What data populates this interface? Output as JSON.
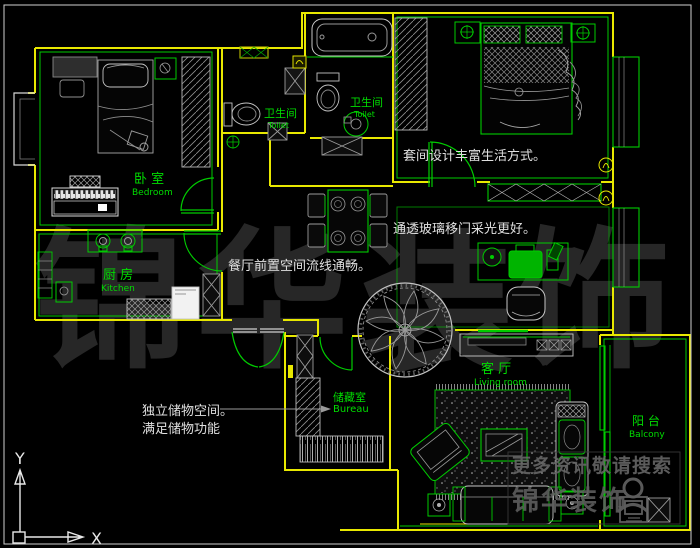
{
  "colors": {
    "background": "#000000",
    "wall": "#e8e800",
    "fixture_green": "#00cc00",
    "detail_gray": "#b5b5b5",
    "label_green": "#00dd00",
    "annotation_white": "#e0e0e0",
    "watermark_dark": "#272727",
    "watermark_gray": "#686868"
  },
  "rooms": {
    "bedroom": {
      "zh": "卧 室",
      "en": "Bedroom"
    },
    "toilet_a": {
      "zh": "卫生间",
      "en": "Toilet"
    },
    "toilet_b": {
      "zh": "卫生间",
      "en": "Toilet"
    },
    "kitchen": {
      "zh": "厨 房",
      "en": "Kitchen"
    },
    "bureau": {
      "zh": "储藏室",
      "en": "Bureau"
    },
    "living": {
      "zh": "客 厅",
      "en": "Living room"
    },
    "balcony": {
      "zh": "阳 台",
      "en": "Balcony"
    }
  },
  "annotations": {
    "suite": "套间设计丰富生活方式。",
    "glass_door": "通透玻璃移门采光更好。",
    "dining_flow": "餐厅前置空间流线通畅。",
    "storage_1": "独立储物空间。",
    "storage_2": "满足储物功能"
  },
  "watermark": {
    "chars": [
      "锦",
      "华",
      "装",
      "饰"
    ],
    "search_line": "更多资讯敬请搜索",
    "brand": "锦华装饰"
  },
  "ucs": {
    "x": "X",
    "y": "Y"
  }
}
